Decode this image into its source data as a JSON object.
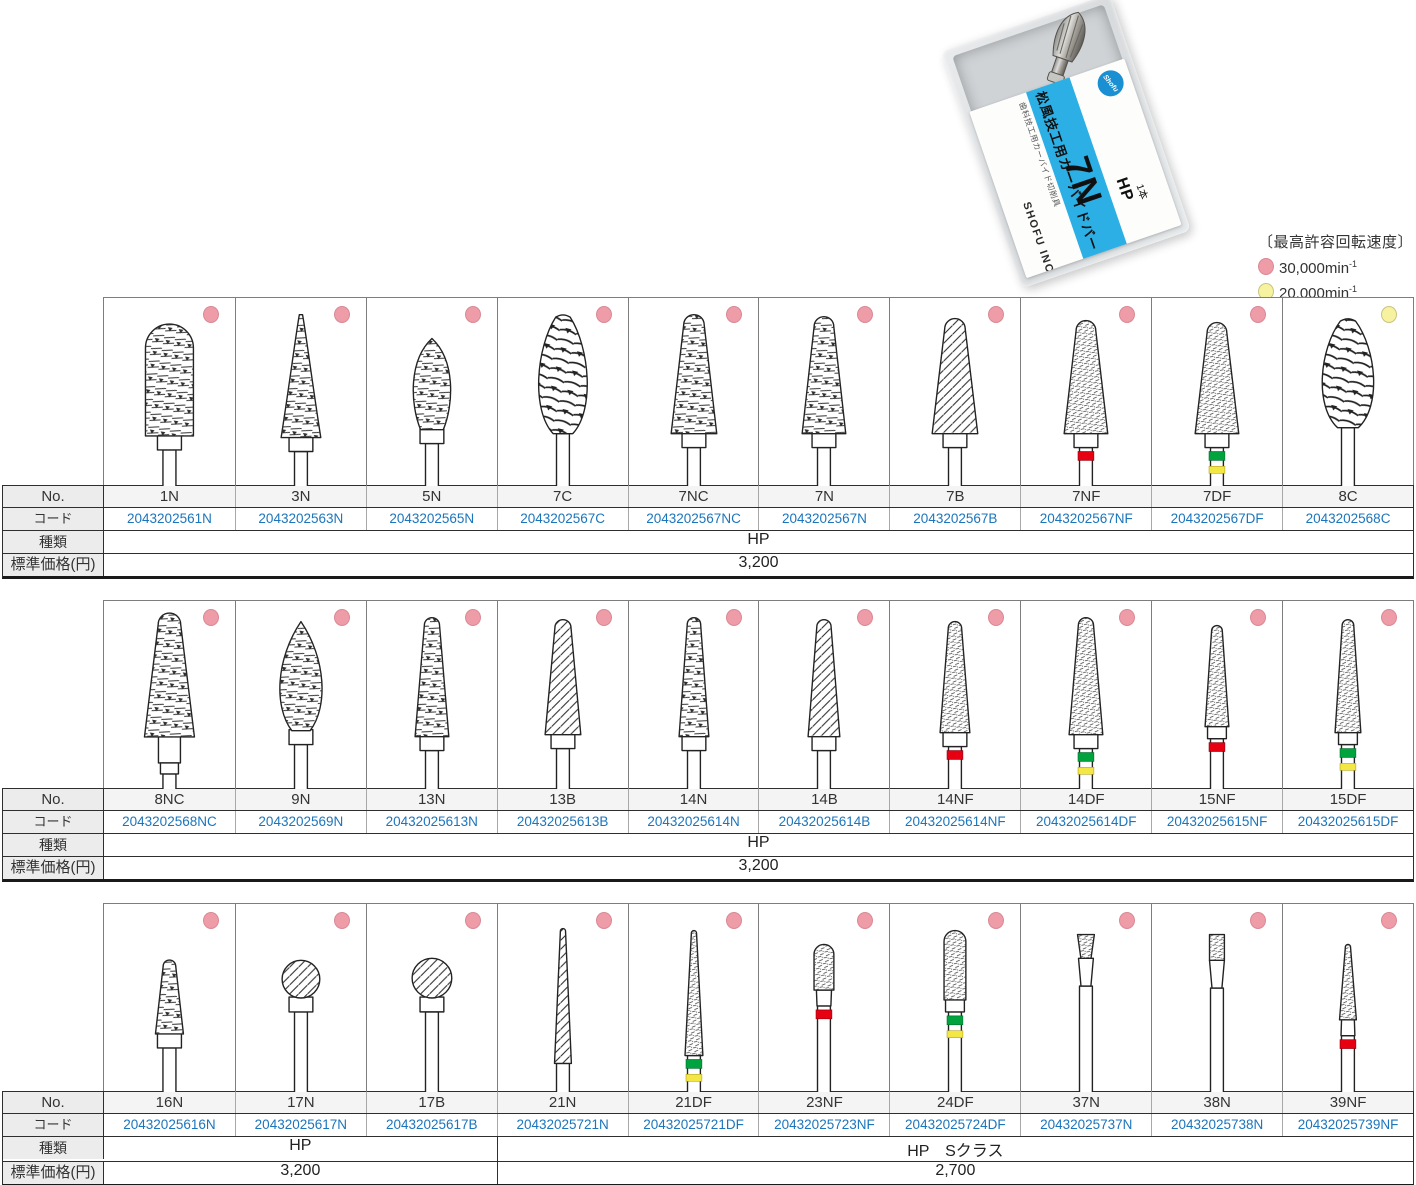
{
  "legend": {
    "title": "〔最高許容回転速度〕",
    "items": [
      {
        "speed": "30,000min",
        "sup": "-1",
        "dot": "pink"
      },
      {
        "speed": "20,000min",
        "sup": "-1",
        "dot": "yellow"
      }
    ]
  },
  "package": {
    "tiny_label": "歯科技工用カーバイド切削具",
    "product_label": "松風技工用カーバイドバー",
    "size_code": "7N",
    "type_code": "HP",
    "quantity": "1本",
    "brand": "SHOFU INC.",
    "logo_text": "Shofu"
  },
  "row_labels": {
    "no": "No.",
    "code": "コード",
    "type": "種類",
    "price": "標準価格(円)"
  },
  "colors": {
    "pink": "#ee9ca7",
    "pink_edge": "#d98995",
    "yellow": "#f6f2a0",
    "yellow_edge": "#c8c480",
    "code_blue": "#1b75bc",
    "red_ring": "#e60012",
    "green_ring": "#00a33e",
    "yellow_ring": "#f2e744",
    "stripe_cyan": "#2bafe4"
  },
  "tables": [
    {
      "columns": [
        {
          "no": "1N",
          "code": "2043202561N",
          "dot": "pink",
          "bur": {
            "shape": "bullet",
            "w": 48,
            "h": 112,
            "top": 26,
            "tex": "coarse",
            "collar": "std",
            "rings": []
          }
        },
        {
          "no": "3N",
          "code": "2043202563N",
          "dot": "pink",
          "bur": {
            "shape": "cone",
            "w": 40,
            "h": 124,
            "top": 16,
            "tex": "coarse",
            "collar": "std",
            "rings": []
          }
        },
        {
          "no": "5N",
          "code": "2043202565N",
          "dot": "pink",
          "bur": {
            "shape": "egg",
            "w": 44,
            "h": 92,
            "top": 40,
            "tex": "coarse",
            "collar": "std",
            "rings": []
          }
        },
        {
          "no": "7C",
          "code": "2043202567C",
          "dot": "pink",
          "bur": {
            "shape": "flame",
            "w": 52,
            "h": 120,
            "top": 16,
            "tex": "big",
            "collar": "none",
            "rings": []
          }
        },
        {
          "no": "7NC",
          "code": "2043202567NC",
          "dot": "pink",
          "bur": {
            "shape": "taper",
            "w": 46,
            "h": 120,
            "top": 16,
            "tex": "coarse",
            "collar": "std",
            "rings": []
          }
        },
        {
          "no": "7N",
          "code": "2043202567N",
          "dot": "pink",
          "bur": {
            "shape": "taper",
            "w": 44,
            "h": 118,
            "top": 18,
            "tex": "coarse",
            "collar": "std",
            "rings": []
          }
        },
        {
          "no": "7B",
          "code": "2043202567B",
          "dot": "pink",
          "bur": {
            "shape": "taper",
            "w": 46,
            "h": 116,
            "top": 20,
            "tex": "diag",
            "collar": "std",
            "rings": []
          }
        },
        {
          "no": "7NF",
          "code": "2043202567NF",
          "dot": "pink",
          "bur": {
            "shape": "taper",
            "w": 44,
            "h": 114,
            "top": 22,
            "tex": "fine",
            "collar": "std",
            "rings": [
              "red"
            ]
          }
        },
        {
          "no": "7DF",
          "code": "2043202567DF",
          "dot": "pink",
          "bur": {
            "shape": "taper",
            "w": 44,
            "h": 112,
            "top": 24,
            "tex": "fine",
            "collar": "std",
            "rings": [
              "green",
              "yellow"
            ]
          }
        },
        {
          "no": "8C",
          "code": "2043202568C",
          "dot": "yellow",
          "bur": {
            "shape": "flame",
            "w": 55,
            "h": 110,
            "top": 20,
            "tex": "big",
            "collar": "none",
            "rings": []
          }
        }
      ],
      "spans": [
        {
          "cols": 10,
          "type": "HP",
          "price": "3,200"
        }
      ]
    },
    {
      "columns": [
        {
          "no": "8NC",
          "code": "2043202568NC",
          "dot": "pink",
          "bur": {
            "shape": "taper",
            "w": 50,
            "h": 124,
            "top": 12,
            "tex": "coarse",
            "collar": "long",
            "rings": []
          }
        },
        {
          "no": "9N",
          "code": "2043202569N",
          "dot": "pink",
          "bur": {
            "shape": "pflame",
            "w": 46,
            "h": 110,
            "top": 20,
            "tex": "coarse",
            "collar": "std",
            "rings": []
          }
        },
        {
          "no": "13N",
          "code": "20432025613N",
          "dot": "pink",
          "bur": {
            "shape": "taper",
            "w": 34,
            "h": 120,
            "top": 16,
            "tex": "coarse",
            "collar": "std",
            "rings": []
          }
        },
        {
          "no": "13B",
          "code": "20432025613B",
          "dot": "pink",
          "bur": {
            "shape": "taper",
            "w": 36,
            "h": 116,
            "top": 18,
            "tex": "diag",
            "collar": "std",
            "rings": []
          }
        },
        {
          "no": "14N",
          "code": "20432025614N",
          "dot": "pink",
          "bur": {
            "shape": "taper",
            "w": 30,
            "h": 120,
            "top": 16,
            "tex": "coarse",
            "collar": "std",
            "rings": []
          }
        },
        {
          "no": "14B",
          "code": "20432025614B",
          "dot": "pink",
          "bur": {
            "shape": "taper",
            "w": 32,
            "h": 118,
            "top": 18,
            "tex": "diag",
            "collar": "std",
            "rings": []
          }
        },
        {
          "no": "14NF",
          "code": "20432025614NF",
          "dot": "pink",
          "bur": {
            "shape": "taper",
            "w": 30,
            "h": 112,
            "top": 20,
            "tex": "fine",
            "collar": "std",
            "rings": [
              "red"
            ]
          }
        },
        {
          "no": "14DF",
          "code": "20432025614DF",
          "dot": "pink",
          "bur": {
            "shape": "taper",
            "w": 34,
            "h": 118,
            "top": 16,
            "tex": "fine",
            "collar": "std",
            "rings": [
              "green",
              "yellow"
            ]
          }
        },
        {
          "no": "15NF",
          "code": "20432025615NF",
          "dot": "pink",
          "bur": {
            "shape": "taper",
            "w": 24,
            "h": 102,
            "top": 24,
            "tex": "fine",
            "collar": "slim",
            "rings": [
              "red"
            ]
          }
        },
        {
          "no": "15DF",
          "code": "20432025615DF",
          "dot": "pink",
          "bur": {
            "shape": "taper",
            "w": 26,
            "h": 114,
            "top": 18,
            "tex": "fine",
            "collar": "slim",
            "rings": [
              "green",
              "yellow"
            ]
          }
        }
      ],
      "spans": [
        {
          "cols": 10,
          "type": "HP",
          "price": "3,200"
        }
      ]
    },
    {
      "columns": [
        {
          "no": "16N",
          "code": "20432025616N",
          "dot": "pink",
          "bur": {
            "shape": "taper",
            "w": 28,
            "h": 74,
            "top": 56,
            "tex": "coarse",
            "collar": "std",
            "rings": []
          }
        },
        {
          "no": "17N",
          "code": "20432025617N",
          "dot": "pink",
          "bur": {
            "shape": "ball",
            "w": 38,
            "h": 38,
            "top": 56,
            "tex": "diag",
            "collar": "std",
            "rings": []
          }
        },
        {
          "no": "17B",
          "code": "20432025617B",
          "dot": "pink",
          "bur": {
            "shape": "ball",
            "w": 40,
            "h": 40,
            "top": 54,
            "tex": "diag",
            "collar": "std",
            "rings": []
          }
        },
        {
          "no": "21N",
          "code": "20432025721N",
          "dot": "pink",
          "bur": {
            "shape": "needle",
            "w": 17,
            "h": 136,
            "top": 24,
            "tex": "diag",
            "collar": "none",
            "rings": []
          }
        },
        {
          "no": "21DF",
          "code": "20432025721DF",
          "dot": "pink",
          "bur": {
            "shape": "needle",
            "w": 18,
            "h": 126,
            "top": 26,
            "tex": "fine",
            "collar": "none",
            "rings": [
              "green",
              "yellow"
            ]
          }
        },
        {
          "no": "23NF",
          "code": "20432025723NF",
          "dot": "pink",
          "bur": {
            "shape": "bullet",
            "w": 20,
            "h": 46,
            "top": 40,
            "tex": "fine",
            "collar": "taperneck",
            "rings": [
              "red"
            ]
          }
        },
        {
          "no": "24DF",
          "code": "20432025724DF",
          "dot": "pink",
          "bur": {
            "shape": "bullet",
            "w": 22,
            "h": 70,
            "top": 26,
            "tex": "fine",
            "collar": "slim",
            "rings": [
              "green",
              "yellow"
            ]
          }
        },
        {
          "no": "37N",
          "code": "20432025737N",
          "dot": "pink",
          "bur": {
            "shape": "invcone",
            "w": 17,
            "h": 24,
            "top": 30,
            "tex": "fine",
            "collar": "neck",
            "rings": []
          }
        },
        {
          "no": "38N",
          "code": "20432025738N",
          "dot": "pink",
          "bur": {
            "shape": "cyl",
            "w": 15,
            "h": 26,
            "top": 30,
            "tex": "fine",
            "collar": "neck",
            "rings": []
          }
        },
        {
          "no": "39NF",
          "code": "20432025739NF",
          "dot": "pink",
          "bur": {
            "shape": "needle",
            "w": 17,
            "h": 76,
            "top": 40,
            "tex": "fine",
            "collar": "taperneck",
            "rings": [
              "red"
            ]
          }
        }
      ],
      "spans": [
        {
          "cols": 3,
          "type": "HP",
          "price": "3,200"
        },
        {
          "cols": 7,
          "type": "HP　Sクラス",
          "price": "2,700"
        }
      ]
    }
  ]
}
